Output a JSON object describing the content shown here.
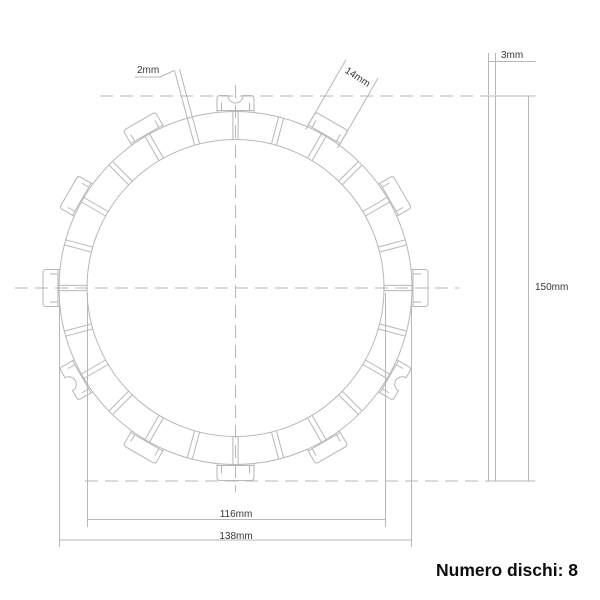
{
  "colors": {
    "line": "#b5b8b8",
    "dim_text": "#383838",
    "caption_text": "#0d0d0d",
    "background": "#ffffff"
  },
  "labels": {
    "groove_width": "2mm",
    "tab_width": "14mm",
    "thickness": "3mm",
    "overall_diameter": "150mm",
    "friction_inner_diameter": "116mm",
    "friction_outer_diameter": "138mm"
  },
  "caption": "Numero dischi: 8",
  "geometry": {
    "center": {
      "x": 235.5,
      "y": 288
    },
    "pad_ring": {
      "outer_radius": 176.5,
      "inner_radius": 148.5,
      "gap_count": 24,
      "gap_step_deg": 15,
      "gap_half_width": 2.6
    },
    "tabs": {
      "outer_radius": 192.5,
      "chord_radius": 177.5,
      "half_width": 18.5,
      "corner_radius": 3,
      "inset": 4.5,
      "inset_len": 8,
      "notch_radius": 7.5,
      "angles_deg": [
        0,
        30,
        60,
        90,
        120,
        150,
        180,
        210,
        240,
        270,
        300,
        330
      ],
      "notched_angles_deg": [
        90,
        210,
        330
      ]
    },
    "leader_2mm": {
      "angle_deg": 105,
      "r_from": 176.5,
      "r_to": 226,
      "underline": [
        135,
        77,
        160,
        77
      ]
    },
    "dim_14mm": {
      "angle_deg": 60,
      "r_from": 172,
      "r_to": 253
    },
    "side_view": {
      "x": 488.5,
      "width": 7,
      "top": 96,
      "bottom": 481
    },
    "centerlines": [
      [
        15,
        288,
        459,
        288
      ],
      [
        235.5,
        85,
        235.5,
        492
      ],
      [
        100,
        96,
        488,
        96
      ],
      [
        85,
        481,
        488,
        481
      ]
    ],
    "dim_lines": [
      [
        87.5,
        293,
        87.5,
        527
      ],
      [
        385.5,
        293,
        385.5,
        527
      ],
      [
        87.5,
        519.5,
        385.5,
        519.5
      ],
      [
        59.5,
        300,
        59.5,
        547
      ],
      [
        411.5,
        300,
        411.5,
        547
      ],
      [
        59.5,
        540,
        411.5,
        540
      ],
      [
        488.5,
        95,
        488.5,
        53
      ],
      [
        495.5,
        95,
        495.5,
        53
      ],
      [
        489,
        61.5,
        535.5,
        61.5
      ],
      [
        495.5,
        96,
        535.5,
        96
      ],
      [
        488.5,
        481,
        535.5,
        481
      ],
      [
        528.5,
        96,
        528.5,
        481
      ]
    ]
  }
}
